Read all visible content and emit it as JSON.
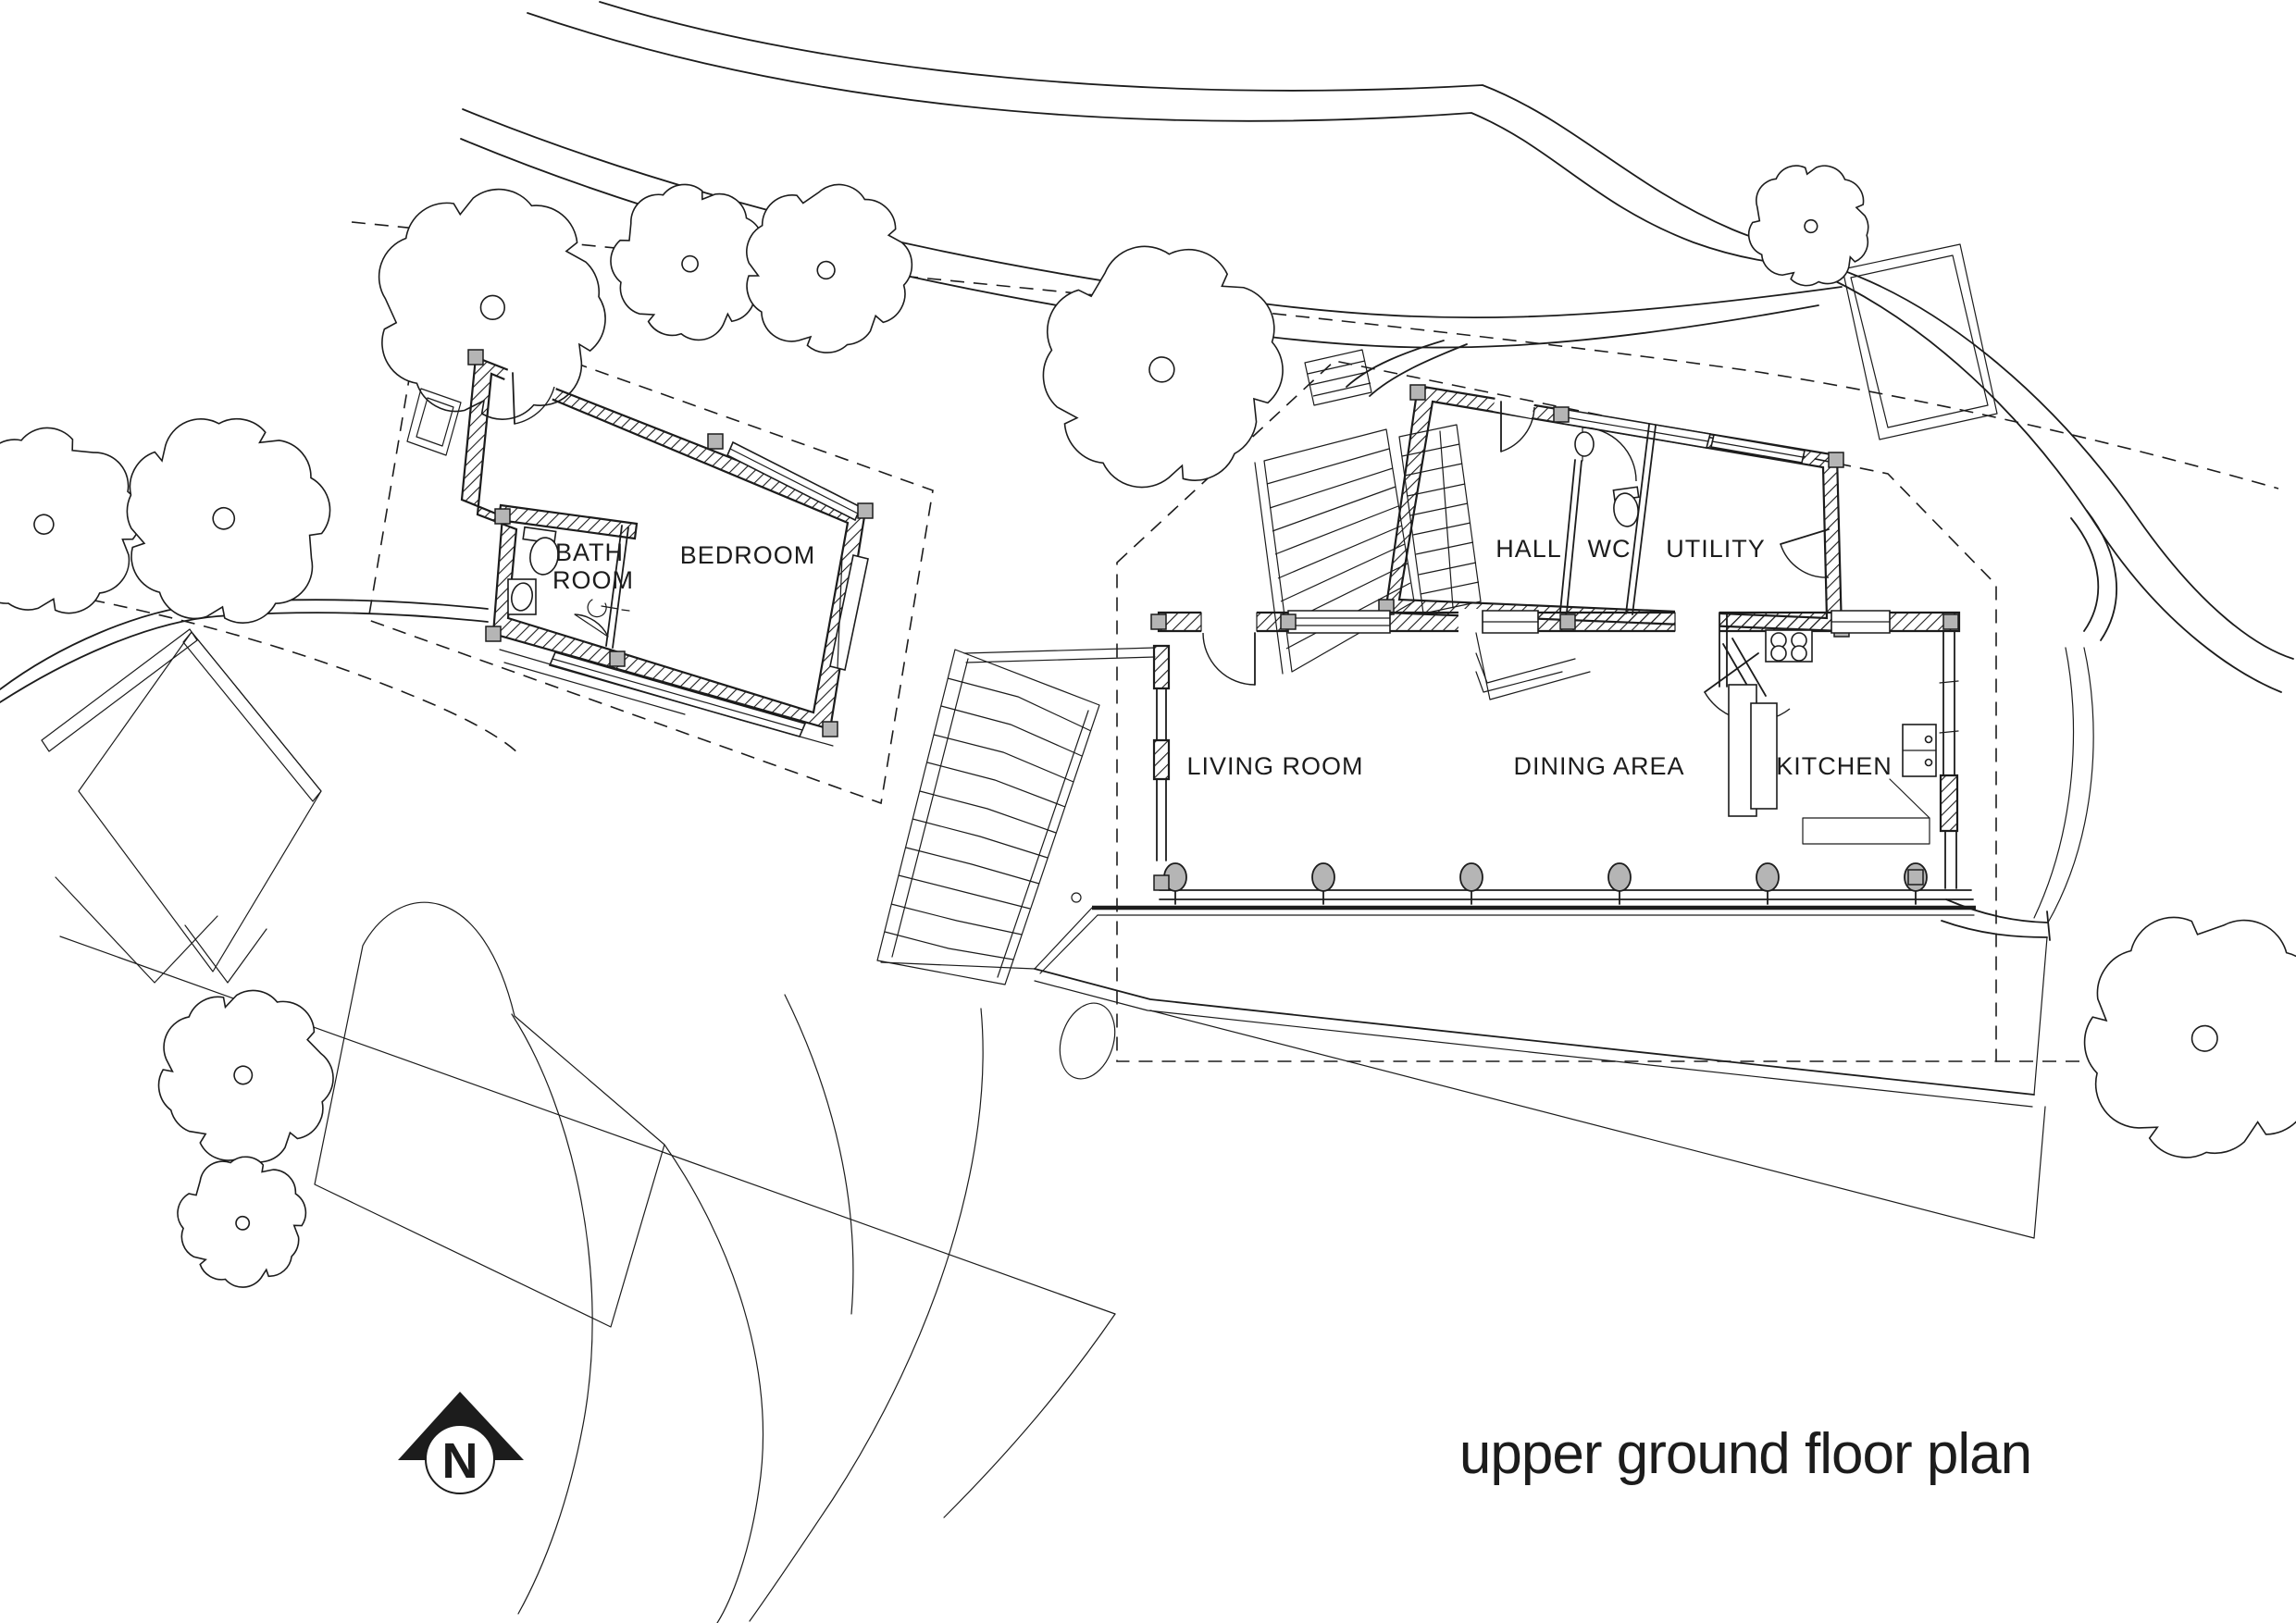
{
  "title": {
    "text": "upper ground floor plan"
  },
  "north": {
    "label": "N"
  },
  "rooms": {
    "bathroom": {
      "line1": "BATH",
      "line2": "ROOM"
    },
    "bedroom": {
      "label": "BEDROOM"
    },
    "hall": {
      "label": "HALL"
    },
    "wc": {
      "label": "WC"
    },
    "utility": {
      "label": "UTILITY"
    },
    "living": {
      "label": "LIVING ROOM"
    },
    "dining": {
      "label": "DINING AREA"
    },
    "kitchen": {
      "label": "KITCHEN"
    }
  },
  "colors": {
    "ink": "#1c1c1c",
    "wall_fill_gray": "#b5b5b5",
    "paper": "#ffffff"
  }
}
